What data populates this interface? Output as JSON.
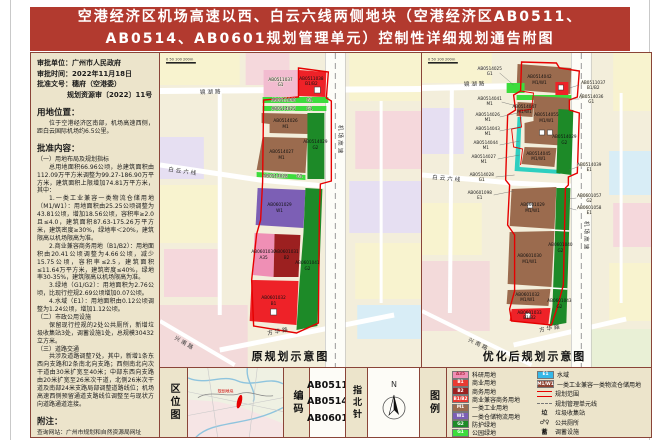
{
  "title": {
    "line1": "空港经济区机场高速以西、白云六线两侧地块（空港经济区AB0511、",
    "line2": "AB0514、AB0601规划管理单元）控制性详细规划通告附图"
  },
  "left_panel": {
    "approval_lines": [
      "审批单位：广州市人民政府",
      "审批时间：2022年11月18日",
      "批准文号：穗府（空港委）",
      "规划资源审〔2022〕11号"
    ],
    "location_heading": "用地位置：",
    "location_text": "位于空港经济区南部，机场高速西侧，距白云国际机场约6.5公里。",
    "content_heading": "批准内容：",
    "paras": [
      "（一）用地布局及规划指标",
      "总用地面积66.96公顷，总建筑面积由112.09万平方米调整为99.27-186.90万平方米，建筑面积上限增加74.81万平方米，其中：",
      "1.一类工业兼容一类物流仓储用地（M1/W1）：用地面积由25.25公顷调整为43.81公顷，增加18.56公顷，容积率≥2.0且≤4.0，建筑面积87.63-175.26万平方米，建筑密度≥30%，绿地率＜20%，建筑限高以机场限高为准。",
      "2.商业兼容商务用地（B1/B2）：用地面积由20.41公顷调整为4.66公顷，减少15.75公顷，容积率≤2.5，建筑面积≤11.64万平方米，建筑密度≤40%，绿地率30-35%，建筑限高以机场限高为准。",
      "3.绿地（G1/G2）：用地面积为2.76公顷，比现行控规2.69公顷增加0.07公顷。",
      "4.水域（E1）：用地面积由0.12公顷调整为1.24公顷，增加1.12公顷。",
      "（二）市政公用设施",
      "保留现行控规的2处公共厕所，新增垃圾收集站3处，调蓄设施1处，总规模30432立方米。",
      "（三）道路交通",
      "共涉及道路调整7处，其中，新增1条东西向支路和2条南北向支路；西侧南北向次干道由30米扩宽至40米；中部东西向支路由20米扩宽至26米次干道，北侧26米次干道及南部24米支路局部调整道路线位；机场高速西侧预留通道支路线位调整至与现状方向道路通道连接。"
    ],
    "note_heading": "附注：",
    "notes": [
      "查询网站：广州市规划和自然资源局网址",
      "（https://ghzyj.gz.gov.cn）",
      "广州空港经济区管理委员会网址",
      "（http://gkm.gz.gov.cn）"
    ]
  },
  "maps": {
    "original": {
      "caption": "原规划示意图",
      "scale_bar": "0 50 100  200m",
      "roads": {
        "jinghu": "镜湖路",
        "baiyunliu": "白云六线",
        "jichang": "机场高速",
        "fanghua": "方华路",
        "xingnan": "兴南路"
      },
      "parcels": [
        {
          "id": "AB0511037",
          "code": "G1"
        },
        {
          "id": "AB0511038",
          "code": "B1/B2"
        },
        {
          "id": "AB0511040",
          "code": "G1"
        },
        {
          "id": "AB0514025",
          "code": "G1"
        },
        {
          "id": "AB0514026",
          "code": "M1"
        },
        {
          "id": "AB0514027",
          "code": "M1"
        },
        {
          "id": "AB0514028",
          "code": "G1"
        },
        {
          "id": "AB0514029",
          "code": "G2"
        },
        {
          "id": "AB0601029",
          "code": "W1"
        },
        {
          "id": "AB0601030",
          "code": "A35"
        },
        {
          "id": "AB0601031",
          "code": "B2"
        },
        {
          "id": "AB0601032",
          "code": "B1"
        },
        {
          "id": "AB0601041",
          "code": "G2"
        }
      ]
    },
    "optimized": {
      "caption": "优化后规划示意图",
      "scale_bar": "0 50 100  200m",
      "roads": {
        "jinghu": "镜湖路",
        "baiyunliu": "白云六线",
        "jichang": "机场高速",
        "fanghua": "方华路",
        "xingnan": "兴南路"
      },
      "parcels": [
        {
          "id": "AB0514025",
          "code": "G1"
        },
        {
          "id": "AB0514042",
          "code": "M1/W1"
        },
        {
          "id": "AB0511037",
          "code": "B1/B2"
        },
        {
          "id": "AB0514036",
          "code": "G1"
        },
        {
          "id": "AB0514041",
          "code": "M1"
        },
        {
          "id": "AB0514047",
          "code": "M1/W1"
        },
        {
          "id": "AB0514026",
          "code": "M1"
        },
        {
          "id": "AB0514043",
          "code": "M1"
        },
        {
          "id": "AB0514055",
          "code": "M1/W1"
        },
        {
          "id": "AB0514044",
          "code": "M1"
        },
        {
          "id": "AB0514027",
          "code": "M1"
        },
        {
          "id": "AB0514045",
          "code": "M1/W1"
        },
        {
          "id": "AB0514028",
          "code": "G1"
        },
        {
          "id": "AB0514029",
          "code": "G2"
        },
        {
          "id": "AB0514039",
          "code": "E1"
        },
        {
          "id": "AB0601098",
          "code": "E1"
        },
        {
          "id": "AB0601029",
          "code": "M1/W1"
        },
        {
          "id": "AB0601030",
          "code": "M1/W1"
        },
        {
          "id": "AB0601032",
          "code": "M1/W1"
        },
        {
          "id": "AB0601033",
          "code": "B1/B2"
        },
        {
          "id": "AB0601040",
          "code": "G2"
        },
        {
          "id": "AB0601043",
          "code": "G2"
        },
        {
          "id": "AB0601057",
          "code": "G2"
        },
        {
          "id": "AB0601058",
          "code": "E1"
        }
      ]
    }
  },
  "bottom": {
    "location_map_label": "区位图",
    "location_map_marker": "规划地块",
    "code_label": "编码",
    "codes": [
      "AB0511",
      "AB0514",
      "AB0601"
    ],
    "compass_label": "指北针",
    "compass_n": "N",
    "legend_label": "图例",
    "legend_left": [
      {
        "code": "A35",
        "label": "科研用地",
        "color": "#ef8fb5",
        "tc": "#b03048"
      },
      {
        "code": "B1",
        "label": "商业用地",
        "color": "#e93a32",
        "tc": "#ffffff"
      },
      {
        "code": "B2",
        "label": "商务用地",
        "color": "#9c2020",
        "tc": "#ffffff"
      },
      {
        "code": "B1/B2",
        "label": "商业兼容商务用地",
        "color": "#e93a32",
        "tc": "#ffffff"
      },
      {
        "code": "M1",
        "label": "一类工业用地",
        "color": "#9b6b4e",
        "tc": "#ffffff"
      },
      {
        "code": "W1",
        "label": "一类仓储物流用地",
        "color": "#7c5fb5",
        "tc": "#ffffff"
      },
      {
        "code": "G2",
        "label": "防护绿地",
        "color": "#1d8a28",
        "tc": "#ffffff"
      },
      {
        "code": "G1",
        "label": "公园绿地",
        "color": "#3ddc3d",
        "tc": "#ffffff"
      }
    ],
    "legend_right": [
      {
        "code": "E1",
        "label": "水域",
        "color": "#35b8e8",
        "tc": "#ffffff"
      },
      {
        "code": "M1/W1",
        "label": "一类工业兼容一类物流仓储用地",
        "color": "#8d4030",
        "tc": "#ffffff"
      },
      {
        "label": "规划范围",
        "color": "#e60000"
      },
      {
        "label": "规划管理单元线",
        "color": "#888888"
      },
      {
        "glyph": "垃",
        "label": "垃圾收集站"
      },
      {
        "glyph": "♂♀",
        "label": "公共厕所"
      },
      {
        "glyph": "蓄",
        "label": "调蓄设施"
      }
    ]
  },
  "colors": {
    "title_bar": "#b23a2f",
    "panel_bg": "#ece4cb",
    "table_border": "#8a4438",
    "boundary_red": "#e60000",
    "a35": "#ef8fb5",
    "b1": "#e93a32",
    "b2": "#9c2020",
    "m1": "#9b6b4e",
    "w1": "#7c5fb5",
    "g2": "#1d8a28",
    "g1": "#3ddc3d",
    "e1": "#35b8e8",
    "m1w1": "#8d4030"
  }
}
